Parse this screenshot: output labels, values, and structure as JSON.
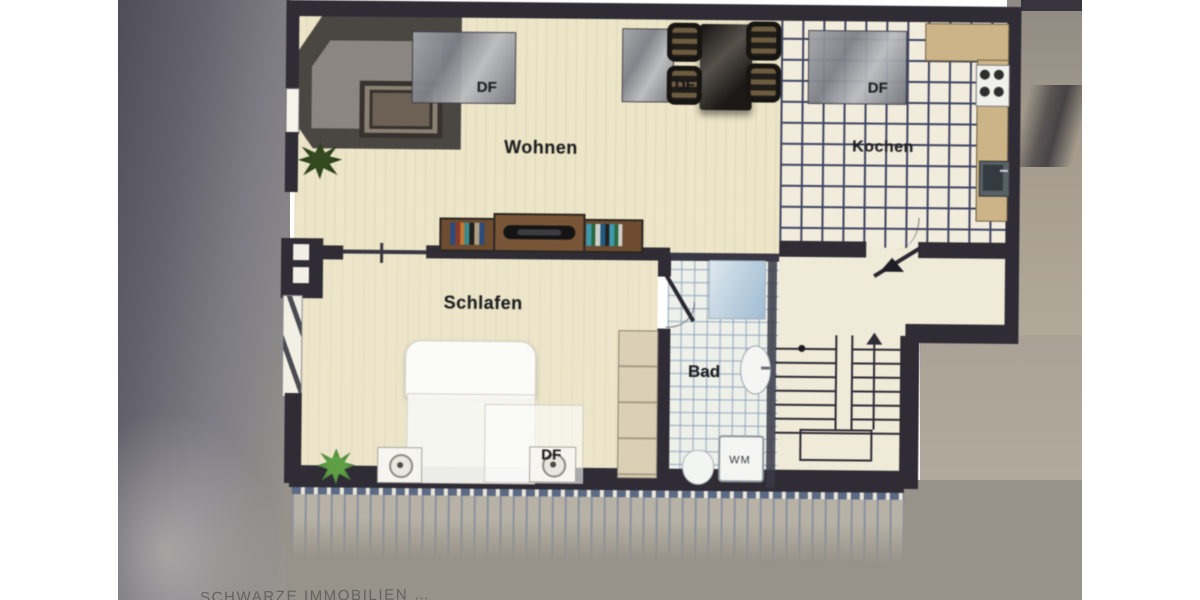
{
  "image": {
    "description": "Photograph of an attic apartment floor plan displayed on a screen",
    "type": "floor-plan"
  },
  "plan": {
    "rooms": {
      "living": "Wohnen",
      "kitchen": "Kochen",
      "bedroom": "Schlafen",
      "bath": "Bad"
    },
    "annotations": {
      "skylight_living": "DF",
      "skylight_dining": "DF",
      "skylight_kitchen": "DF",
      "skylight_bedroom": "DF",
      "washing_machine": "WM"
    },
    "furniture_legend": {
      "corner-sofa": "dark L-shaped sofa with coffee table",
      "tv-sideboard": "lowboard with TV and books",
      "dining-set": "table with four chairs",
      "stove": "4-burner cooktop",
      "kitchen-sink": "sink unit",
      "shower": "shower tray",
      "wash-basin": "oval basin",
      "toilet": "WC",
      "bed": "double bed with two nightstands",
      "wardrobe": "closet",
      "stairs": "staircase with up arrow",
      "entrance": "entry door with direction arrow",
      "plants": "two potted plants"
    },
    "colors": {
      "wall": "#2f2c35",
      "floor_wood": "#ece5c6",
      "floor_tile_kitchen": "#f1ecdb",
      "kitchen_grid_line": "#3f4564",
      "bath_grid_line": "#9db2c6",
      "skylight_gray": "#8e9096",
      "counter_tan": "#cdb486",
      "hatch_blue": "#5c6a86",
      "plant_green": "#4e8f38"
    }
  },
  "watermark": {
    "text": "SCHWARZE IMMOBILIEN …"
  }
}
